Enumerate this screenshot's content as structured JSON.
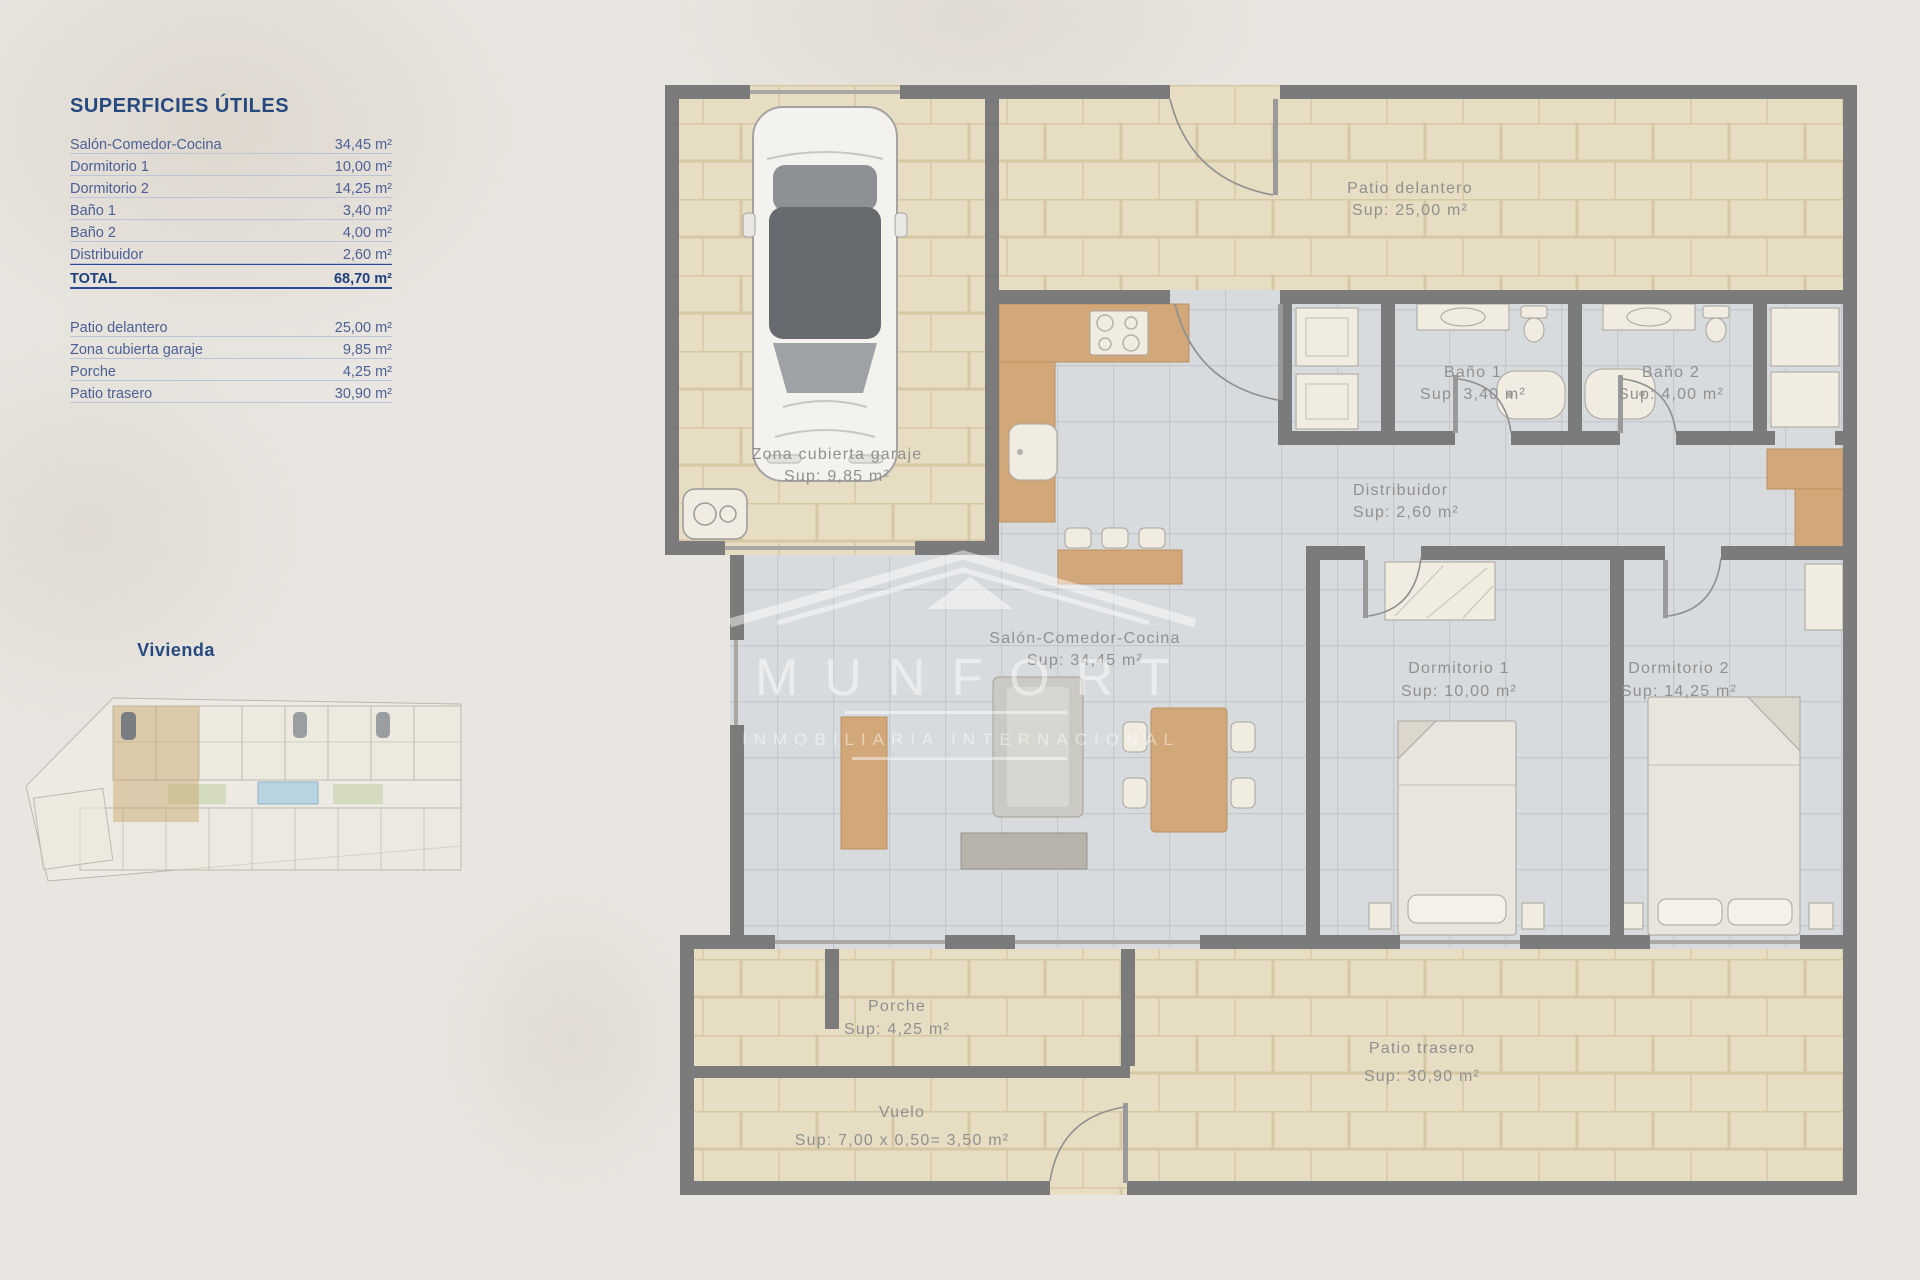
{
  "surfaces_table": {
    "title": "SUPERFICIES ÚTILES",
    "rows": [
      {
        "label": "Salón-Comedor-Cocina",
        "value": "34,45 m²"
      },
      {
        "label": "Dormitorio 1",
        "value": "10,00 m²"
      },
      {
        "label": "Dormitorio 2",
        "value": "14,25 m²"
      },
      {
        "label": "Baño 1",
        "value": "3,40 m²"
      },
      {
        "label": "Baño 2",
        "value": "4,00 m²"
      },
      {
        "label": "Distribuidor",
        "value": "2,60 m²"
      }
    ],
    "total": {
      "label": "TOTAL",
      "value": "68,70 m²"
    },
    "exterior_rows": [
      {
        "label": "Patio delantero",
        "value": "25,00 m²"
      },
      {
        "label": "Zona cubierta garaje",
        "value": "9,85 m²"
      },
      {
        "label": "Porche",
        "value": "4,25 m²"
      },
      {
        "label": "Patio trasero",
        "value": "30,90 m²"
      }
    ]
  },
  "site_plan": {
    "label": "Vivienda"
  },
  "floor_plan": {
    "rooms": [
      {
        "id": "patio-delantero",
        "name": "Patio delantero",
        "sup": "Sup: 25,00 m²"
      },
      {
        "id": "zona-cubierta-garaje",
        "name": "Zona cubierta garaje",
        "sup": "Sup: 9,85 m²"
      },
      {
        "id": "bano-1",
        "name": "Baño 1",
        "sup": "Sup: 3,40 m²"
      },
      {
        "id": "bano-2",
        "name": "Baño 2",
        "sup": "Sup: 4,00 m²"
      },
      {
        "id": "distribuidor",
        "name": "Distribuidor",
        "sup": "Sup: 2,60 m²"
      },
      {
        "id": "salon-comedor-cocina",
        "name": "Salón-Comedor-Cocina",
        "sup": "Sup: 34,45 m²"
      },
      {
        "id": "dormitorio-1",
        "name": "Dormitorio 1",
        "sup": "Sup: 10,00 m²"
      },
      {
        "id": "dormitorio-2",
        "name": "Dormitorio 2",
        "sup": "Sup: 14,25 m²"
      },
      {
        "id": "porche",
        "name": "Porche",
        "sup": "Sup: 4,25 m²"
      },
      {
        "id": "patio-trasero",
        "name": "Patio trasero",
        "sup": "Sup: 30,90 m²"
      },
      {
        "id": "vuelo",
        "name": "Vuelo",
        "sup": "Sup: 7,00 x 0,50= 3,50 m²"
      }
    ]
  },
  "watermark": {
    "name": "MUNFORT",
    "subtitle": "INMOBILIARIA INTERNACIONAL"
  },
  "colors": {
    "accent_blue": "#27497f",
    "table_text_blue": "#4c6095",
    "plan_label_gray": "#909090",
    "wall_gray": "#7b7b7b",
    "patio_tile_tan": "#e7ddc2",
    "interior_tile_gray": "#d8dbde",
    "wood": "#d2a87a",
    "fixture_white": "#f0ece1",
    "watermark_white": "#ffffff"
  }
}
